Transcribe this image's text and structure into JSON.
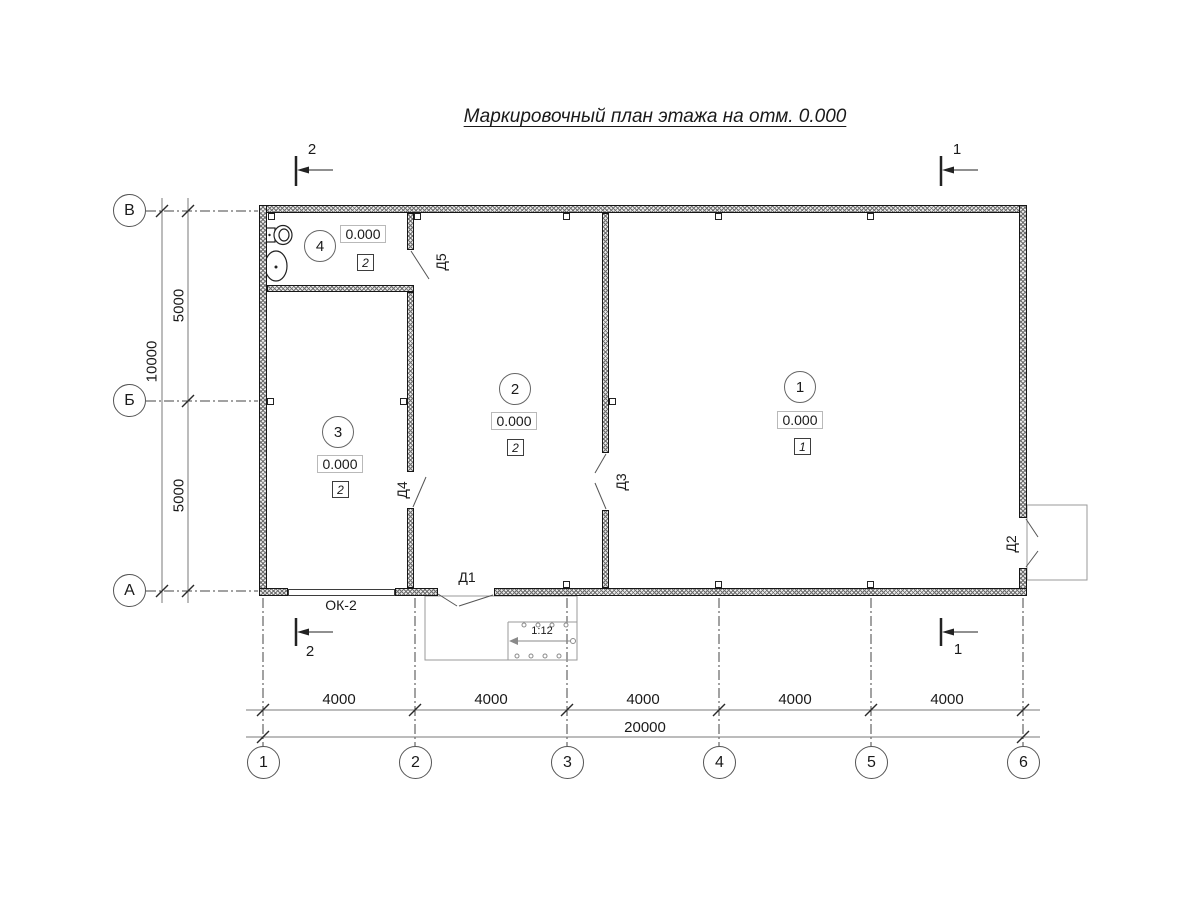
{
  "title": "Маркировочный план этажа на отм. 0.000",
  "axes_bottom": [
    "1",
    "2",
    "3",
    "4",
    "5",
    "6"
  ],
  "axes_left": [
    "В",
    "Б",
    "А"
  ],
  "dims_bottom": {
    "segments": [
      "4000",
      "4000",
      "4000",
      "4000",
      "4000"
    ],
    "total": "20000"
  },
  "dims_left": {
    "segments": [
      "5000",
      "5000"
    ],
    "total": "10000"
  },
  "rooms": [
    {
      "number": "1",
      "elevation": "0.000",
      "finish": "1"
    },
    {
      "number": "2",
      "elevation": "0.000",
      "finish": "2"
    },
    {
      "number": "3",
      "elevation": "0.000",
      "finish": "2"
    },
    {
      "number": "4",
      "elevation": "0.000",
      "finish": "2"
    }
  ],
  "doors": {
    "d1": "Д1",
    "d2": "Д2",
    "d3": "Д3",
    "d4": "Д4",
    "d5": "Д5"
  },
  "window_label": "ОК-2",
  "ramp_slope": "1:12",
  "sections": {
    "top_left": "2",
    "top_right": "1",
    "bottom_left": "2",
    "bottom_right": "1"
  },
  "icons": [
    "toilet-icon",
    "sink-icon"
  ],
  "colors": {
    "line": "#1a1a1a",
    "secondary": "#777777",
    "background": "#ffffff"
  }
}
